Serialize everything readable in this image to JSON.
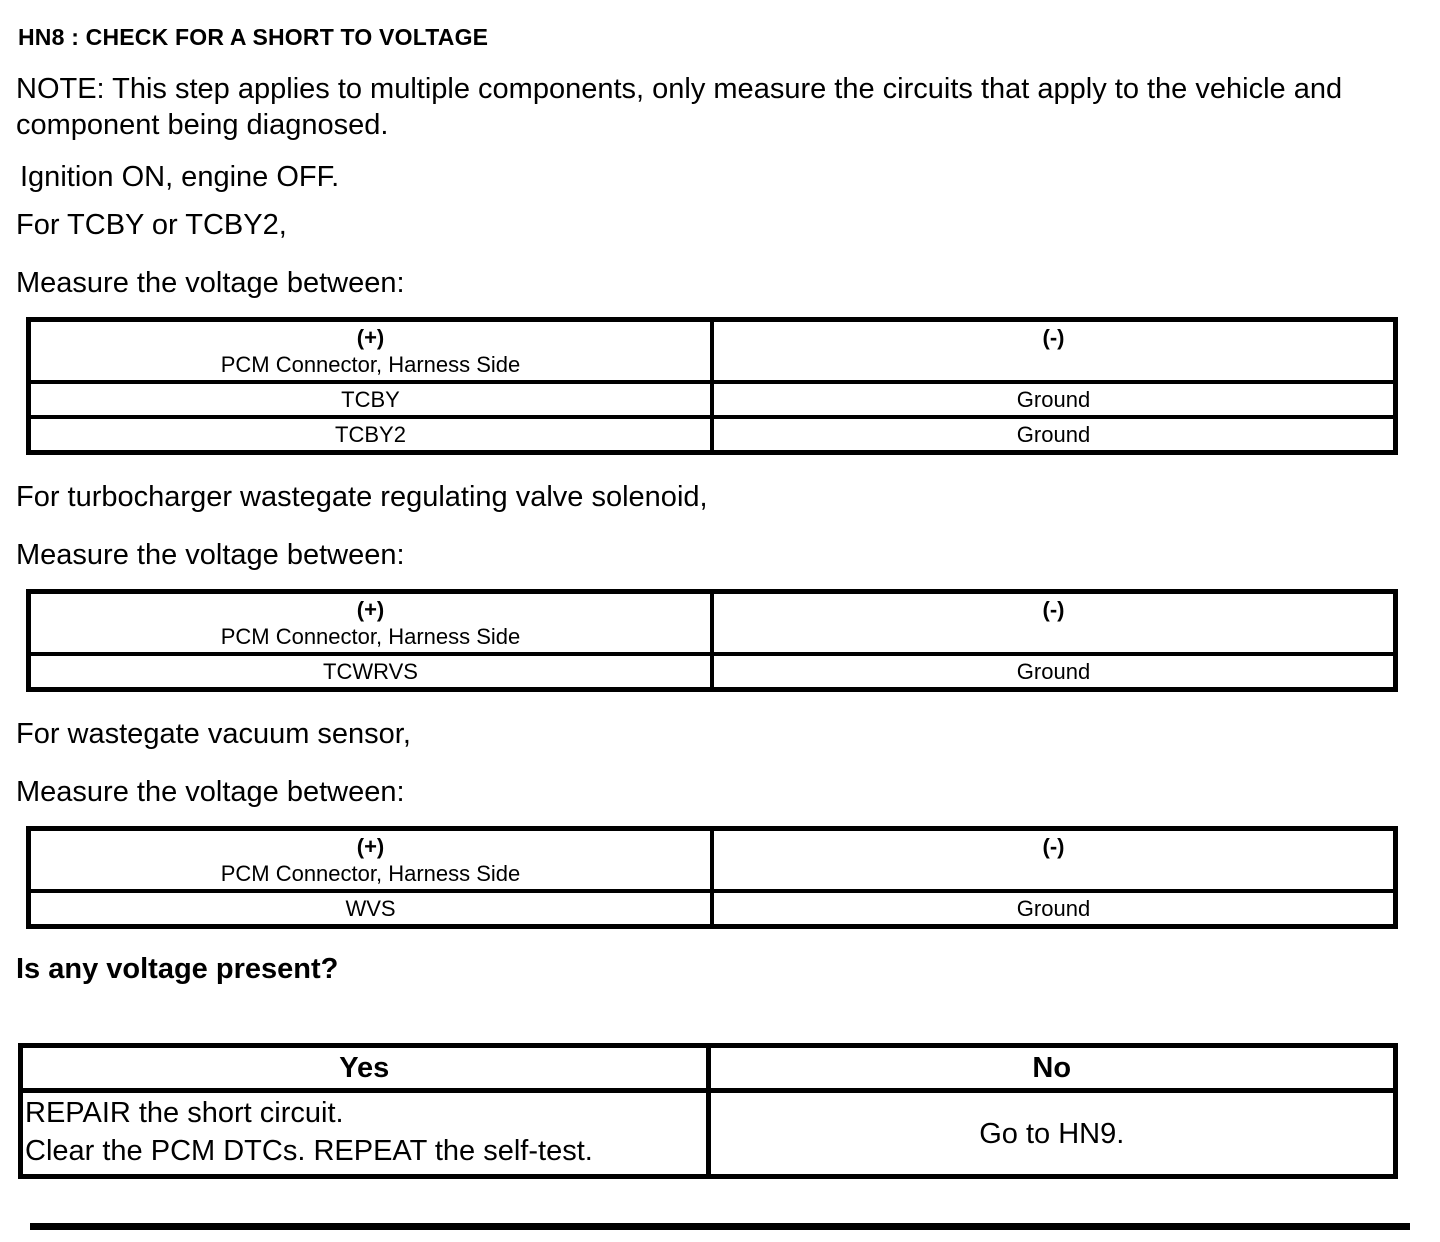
{
  "page": {
    "title": "HN8 : CHECK FOR A SHORT TO VOLTAGE",
    "note": "NOTE: This step applies to multiple components, only measure the circuits that apply to the vehicle and component being diagnosed.",
    "ignition": "Ignition ON, engine OFF.",
    "question": "Is any voltage present?"
  },
  "colors": {
    "text": "#000000",
    "background": "#ffffff",
    "border": "#000000"
  },
  "sections": [
    {
      "intro": "For TCBY or TCBY2,",
      "measure": "Measure the voltage between:",
      "table": {
        "pos_sign": "(+)",
        "pos_header": "PCM Connector, Harness Side",
        "neg_sign": "(-)",
        "rows": [
          {
            "pos": "TCBY",
            "neg": "Ground"
          },
          {
            "pos": "TCBY2",
            "neg": "Ground"
          }
        ]
      }
    },
    {
      "intro": "For turbocharger wastegate regulating valve solenoid,",
      "measure": "Measure the voltage between:",
      "table": {
        "pos_sign": "(+)",
        "pos_header": "PCM Connector, Harness Side",
        "neg_sign": "(-)",
        "rows": [
          {
            "pos": "TCWRVS",
            "neg": "Ground"
          }
        ]
      }
    },
    {
      "intro": "For wastegate vacuum sensor,",
      "measure": "Measure the voltage between:",
      "table": {
        "pos_sign": "(+)",
        "pos_header": "PCM Connector, Harness Side",
        "neg_sign": "(-)",
        "rows": [
          {
            "pos": "WVS",
            "neg": "Ground"
          }
        ]
      }
    }
  ],
  "decision": {
    "yes_label": "Yes",
    "no_label": "No",
    "yes_action_line1": "REPAIR the short circuit.",
    "yes_action_line2": "Clear the PCM DTCs. REPEAT the self-test.",
    "no_action": "Go to HN9."
  }
}
